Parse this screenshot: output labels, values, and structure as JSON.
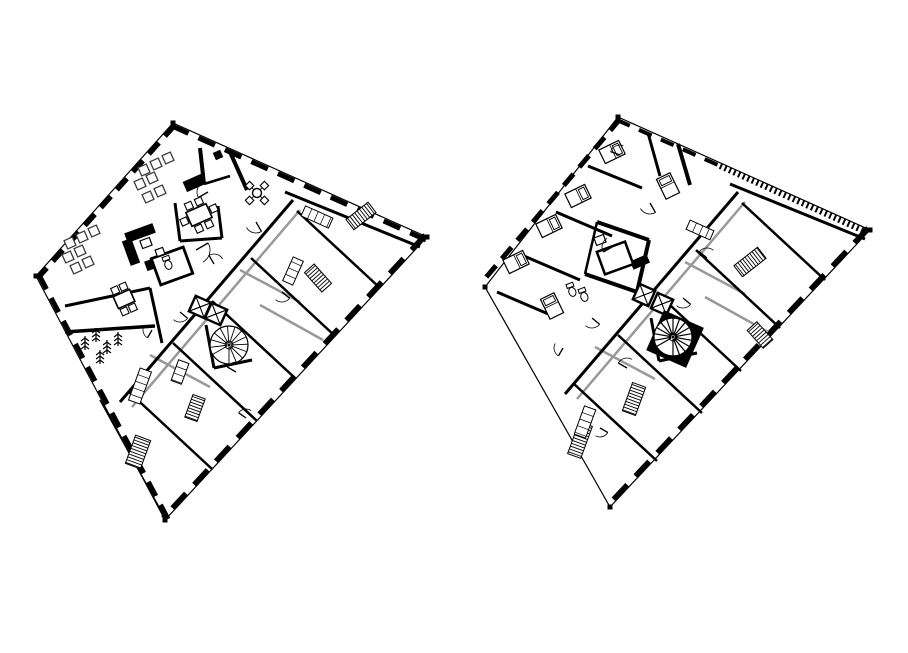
{
  "canvas": {
    "width": 908,
    "height": 653,
    "background": "#ffffff",
    "ink": "#000000",
    "gray": "#999999",
    "furniture_stroke": "#3a3a3a"
  },
  "figure": {
    "kind": "architectural-floor-plans",
    "plan_count": 2
  },
  "plans": [
    {
      "name": "floor-plan-left",
      "outline": [
        [
          173,
          123
        ],
        [
          427,
          237
        ],
        [
          165,
          520
        ],
        [
          36,
          276
        ]
      ],
      "edge_walls": [
        [
          172,
          126,
          426,
          240,
          5,
          "18 11"
        ],
        [
          425,
          235,
          163,
          518,
          5,
          "20 12"
        ],
        [
          39,
          275,
          168,
          519,
          5,
          "16 10"
        ],
        [
          175,
          125,
          38,
          278,
          5,
          "15 9"
        ]
      ],
      "walls": [
        [
          293,
          200,
          120,
          402,
          3
        ],
        [
          297,
          211,
          380,
          288,
          2.5
        ],
        [
          251,
          258,
          335,
          336,
          2.5
        ],
        [
          212,
          301,
          296,
          379,
          2.5
        ],
        [
          173,
          343,
          257,
          421,
          2.5
        ],
        [
          128,
          391,
          212,
          469,
          2.5
        ],
        [
          285,
          192,
          420,
          247,
          3
        ],
        [
          230,
          152,
          247,
          190,
          4
        ],
        [
          200,
          148,
          204,
          184,
          4
        ],
        [
          204,
          184,
          230,
          176,
          2.5
        ],
        [
          175,
          203,
          180,
          241,
          3
        ],
        [
          180,
          241,
          222,
          238,
          3
        ],
        [
          222,
          238,
          218,
          206,
          3
        ],
        [
          65,
          306,
          150,
          288,
          3
        ],
        [
          150,
          288,
          162,
          343,
          3
        ],
        [
          65,
          332,
          155,
          326,
          3.5
        ],
        [
          206,
          325,
          214,
          368,
          3
        ],
        [
          214,
          368,
          252,
          360,
          3
        ],
        [
          100,
          400,
          165,
          518,
          1.5
        ]
      ],
      "gray_walls": [
        [
          300,
          210,
          132,
          407,
          2.5
        ],
        [
          260,
          305,
          323,
          340,
          2.5
        ],
        [
          150,
          355,
          210,
          387,
          2.5
        ],
        [
          240,
          270,
          300,
          302,
          2.5
        ]
      ],
      "hatches": [
        [
          361,
          216,
          28,
          13,
          -38
        ],
        [
          318,
          278,
          26,
          13,
          48
        ],
        [
          138,
          452,
          30,
          16,
          110
        ],
        [
          195,
          408,
          24,
          13,
          110
        ]
      ],
      "black_rects": [
        [
          140,
          233,
          30,
          10,
          -20
        ],
        [
          131,
          252,
          10,
          26,
          -20
        ],
        [
          158,
          262,
          26,
          10,
          -20
        ],
        [
          194,
          183,
          20,
          11,
          -24
        ],
        [
          218,
          155,
          8,
          8,
          -24
        ]
      ],
      "rooms": [
        [
          172,
          266,
          34,
          28,
          -20,
          2.8
        ],
        [
          146,
          243,
          10,
          8,
          -20,
          1.2
        ],
        [
          160,
          252,
          8,
          7,
          -20,
          1.2
        ]
      ],
      "counters": [
        [
          317,
          217,
          30,
          11,
          24
        ],
        [
          293,
          271,
          26,
          11,
          -66
        ],
        [
          140,
          386,
          12,
          34,
          20
        ],
        [
          180,
          372,
          11,
          22,
          20
        ]
      ],
      "elevators": [
        [
          200,
          307,
          17,
          24
        ],
        [
          216,
          314,
          17,
          24
        ]
      ],
      "spiral": {
        "cx": 229,
        "cy": 345,
        "r": 19,
        "steps": 13,
        "dark": false
      },
      "sofas": [
        [
          144,
          170
        ],
        [
          156,
          164
        ],
        [
          168,
          158
        ],
        [
          140,
          184
        ],
        [
          152,
          178
        ],
        [
          148,
          197
        ],
        [
          160,
          191
        ],
        [
          70,
          243
        ],
        [
          82,
          237
        ],
        [
          94,
          231
        ],
        [
          68,
          257
        ],
        [
          80,
          251
        ],
        [
          76,
          268
        ],
        [
          88,
          262
        ]
      ],
      "tables": [
        {
          "cx": 199,
          "cy": 215,
          "w": 22,
          "h": 15,
          "rot": -24,
          "chairs": 6
        },
        {
          "cx": 124,
          "cy": 299,
          "w": 18,
          "h": 13,
          "rot": -24,
          "chairs": 4
        }
      ],
      "round_tables": [
        {
          "cx": 257,
          "cy": 193,
          "r": 4.5,
          "chairs": 4
        }
      ],
      "beds": [],
      "toilets": [
        [
          168,
          264,
          -20
        ]
      ],
      "trees": [
        [
          85,
          344
        ],
        [
          96,
          336
        ],
        [
          107,
          348
        ],
        [
          118,
          340
        ],
        [
          100,
          358
        ]
      ],
      "door_arcs": [
        [
          208,
          192,
          11,
          150
        ],
        [
          256,
          222,
          11,
          60
        ],
        [
          214,
          264,
          10,
          240
        ],
        [
          196,
          250,
          14,
          330
        ],
        [
          180,
          312,
          10,
          40
        ],
        [
          236,
          372,
          10,
          210
        ],
        [
          282,
          292,
          10,
          40
        ],
        [
          152,
          330,
          9,
          120
        ],
        [
          246,
          418,
          9,
          215
        ]
      ]
    },
    {
      "name": "floor-plan-right",
      "outline": [
        [
          618,
          117
        ],
        [
          870,
          230
        ],
        [
          610,
          507
        ],
        [
          485,
          287
        ]
      ],
      "edge_walls": [
        [
          617,
          120,
          718,
          165,
          4,
          "14 10"
        ],
        [
          720,
          166,
          866,
          232,
          6,
          "2 3"
        ],
        [
          868,
          228,
          608,
          505,
          5,
          "20 12"
        ],
        [
          620,
          119,
          483,
          281,
          5,
          "15 9"
        ]
      ],
      "walls": [
        [
          738,
          192,
          565,
          394,
          3
        ],
        [
          742,
          203,
          825,
          280,
          2.5
        ],
        [
          696,
          250,
          780,
          328,
          2.5
        ],
        [
          657,
          293,
          741,
          371,
          2.5
        ],
        [
          618,
          335,
          702,
          413,
          2.5
        ],
        [
          573,
          383,
          657,
          461,
          2.5
        ],
        [
          730,
          184,
          865,
          239,
          3
        ],
        [
          597,
          222,
          649,
          240,
          4
        ],
        [
          649,
          240,
          637,
          292,
          4
        ],
        [
          637,
          292,
          585,
          274,
          4
        ],
        [
          585,
          274,
          597,
          222,
          2.5
        ],
        [
          648,
          133,
          660,
          176,
          3
        ],
        [
          678,
          144,
          690,
          185,
          4
        ],
        [
          588,
          166,
          642,
          188,
          3
        ],
        [
          556,
          212,
          612,
          236,
          3
        ],
        [
          524,
          256,
          580,
          280,
          3
        ],
        [
          497,
          292,
          553,
          316,
          3
        ],
        [
          651,
          318,
          659,
          361,
          3
        ],
        [
          659,
          361,
          697,
          353,
          3
        ]
      ],
      "gray_walls": [
        [
          745,
          202,
          577,
          399,
          2.5
        ],
        [
          705,
          297,
          768,
          332,
          2.5
        ],
        [
          595,
          347,
          655,
          379,
          2.5
        ],
        [
          685,
          262,
          745,
          294,
          2.5
        ]
      ],
      "hatches": [
        [
          750,
          262,
          30,
          14,
          -38
        ],
        [
          760,
          335,
          24,
          13,
          48
        ],
        [
          634,
          399,
          30,
          14,
          110
        ],
        [
          580,
          440,
          34,
          14,
          110
        ]
      ],
      "black_rects": [
        [
          640,
          262,
          18,
          9,
          -24
        ]
      ],
      "rooms": [
        [
          615,
          258,
          30,
          24,
          -20,
          2.5
        ],
        [
          600,
          240,
          10,
          8,
          -20,
          1.2
        ]
      ],
      "counters": [
        [
          700,
          230,
          26,
          10,
          24
        ],
        [
          585,
          422,
          12,
          30,
          20
        ]
      ],
      "elevators": [
        [
          644,
          295,
          17,
          24
        ],
        [
          662,
          304,
          17,
          24
        ]
      ],
      "spiral": {
        "cx": 673,
        "cy": 337,
        "r": 19,
        "steps": 15,
        "dark": true
      },
      "sofas": [],
      "tables": [],
      "round_tables": [],
      "beds": [
        [
          612,
          152,
          64
        ],
        [
          578,
          196,
          64
        ],
        [
          549,
          226,
          64
        ],
        [
          516,
          262,
          64
        ],
        [
          668,
          186,
          -26
        ],
        [
          552,
          306,
          -26
        ]
      ],
      "toilets": [
        [
          572,
          291,
          -20
        ],
        [
          584,
          296,
          -20
        ]
      ],
      "trees": [],
      "door_arcs": [
        [
          650,
          203,
          11,
          60
        ],
        [
          612,
          247,
          10,
          150
        ],
        [
          592,
          318,
          10,
          40
        ],
        [
          627,
          368,
          10,
          210
        ],
        [
          683,
          298,
          10,
          40
        ],
        [
          707,
          258,
          10,
          220
        ],
        [
          563,
          348,
          9,
          120
        ],
        [
          600,
          428,
          9,
          30
        ],
        [
          620,
          155,
          10,
          200
        ]
      ]
    }
  ]
}
